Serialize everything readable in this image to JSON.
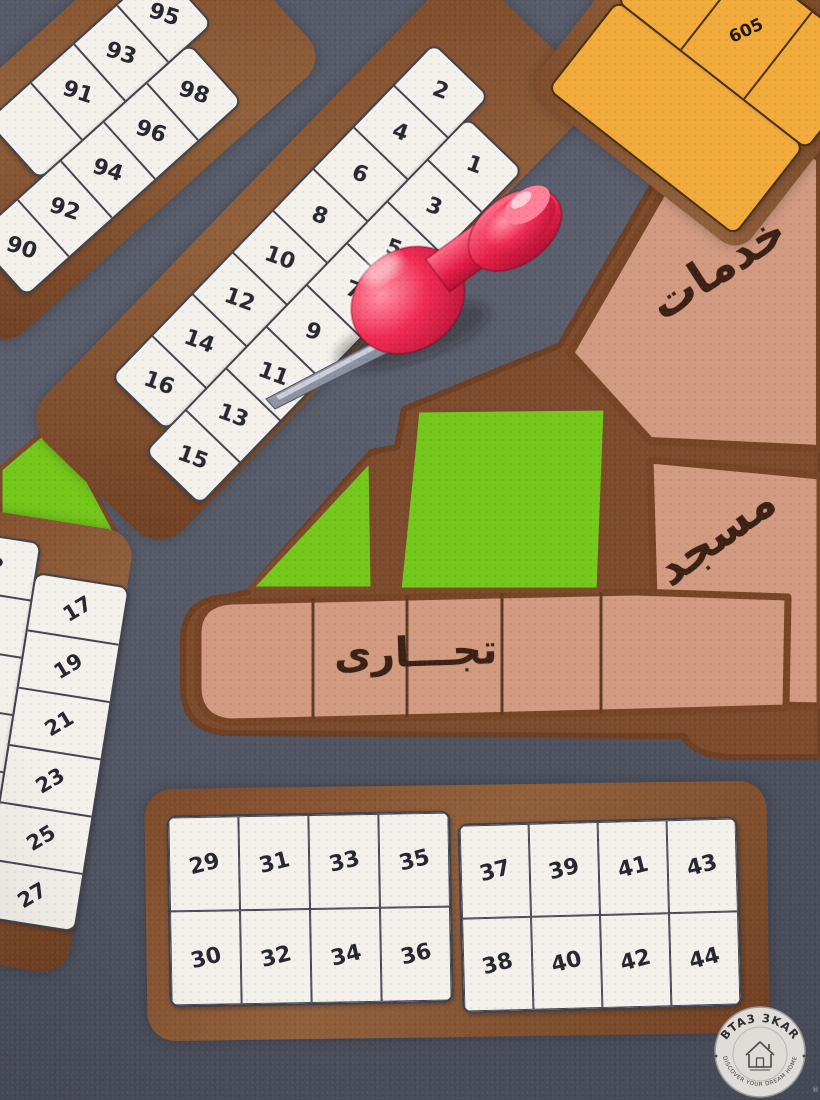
{
  "map": {
    "colors": {
      "road": "#545866",
      "block_brown": "#7e4b2a",
      "plot_white": "#f4f1ec",
      "plot_line": "#42424b",
      "area_tan": "#d29a80",
      "park_green": "#74c81a",
      "plot_orange": "#f2ab3a",
      "pin_red": "#e8254e",
      "number_dark": "#26262e"
    }
  },
  "blocks": {
    "b90": {
      "col_left": [
        "95",
        "93",
        "91",
        ""
      ],
      "col_right": [
        "98",
        "96",
        "94",
        "92",
        "90"
      ]
    },
    "b1": {
      "col_even": [
        "2",
        "4",
        "6",
        "8",
        "10",
        "12",
        "14",
        "16"
      ],
      "col_odd": [
        "1",
        "3",
        "5",
        "7",
        "9",
        "11",
        "13",
        "15"
      ]
    },
    "left": {
      "col_left": [
        "18",
        "",
        "",
        "",
        "",
        ""
      ],
      "col_right": [
        "17",
        "19",
        "21",
        "23",
        "25",
        "27"
      ]
    },
    "b29": {
      "cells": [
        "29",
        "31",
        "33",
        "35",
        "30",
        "32",
        "34",
        "36"
      ]
    },
    "b37": {
      "cells": [
        "37",
        "39",
        "41",
        "43",
        "38",
        "40",
        "42",
        "44"
      ]
    },
    "b605": {
      "col": [
        "607",
        "605",
        ""
      ]
    }
  },
  "labels": {
    "services": "خدمات",
    "mosque": "مسجد",
    "commercial": "تجـــارى"
  },
  "watermark": {
    "brand": "BTA3 3KAR",
    "tagline": "DISCOVER YOUR DREAM HOME",
    "registered": "®"
  }
}
